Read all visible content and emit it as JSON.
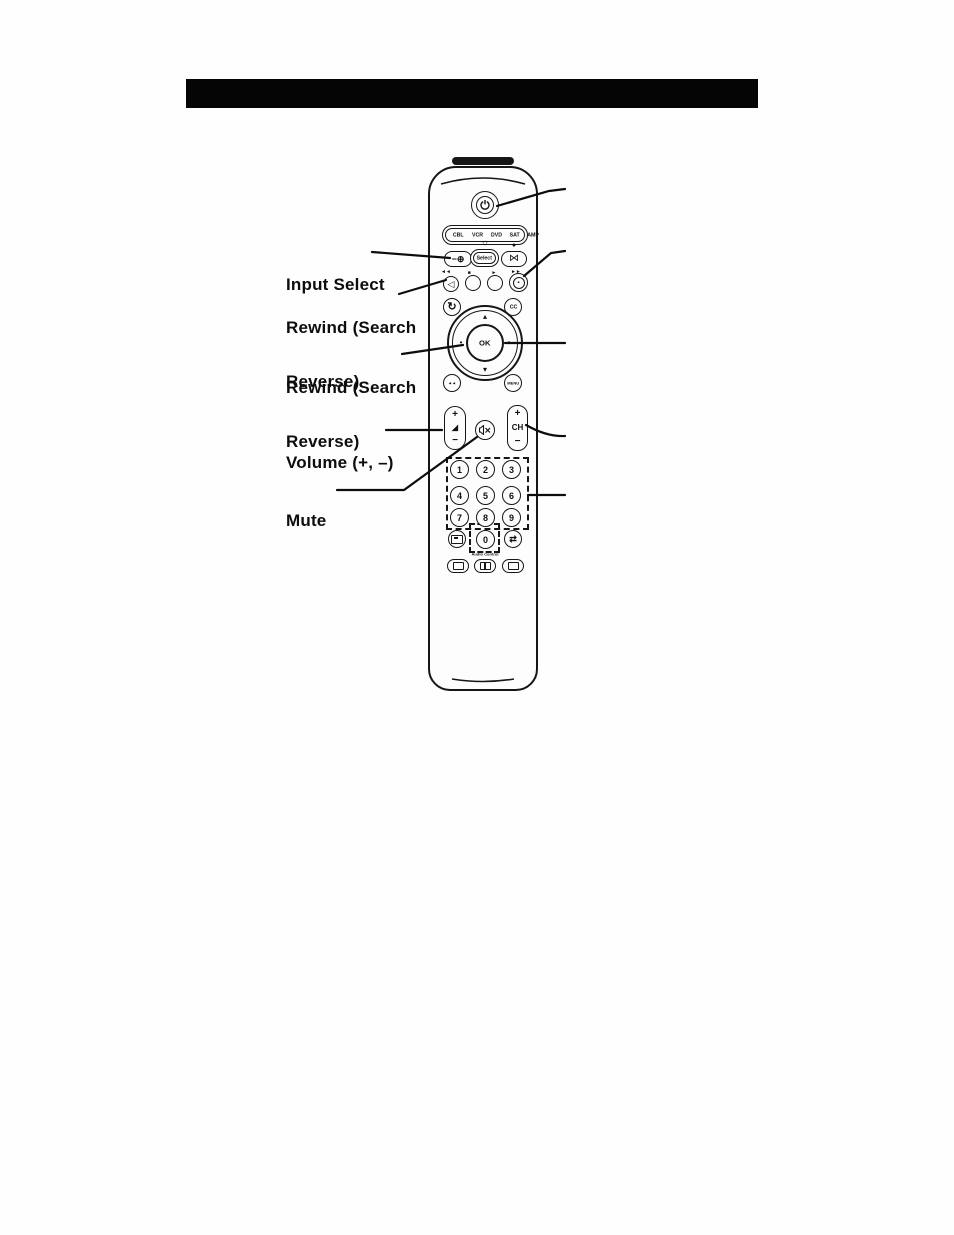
{
  "page": {
    "bg": "#ffffff",
    "ink": "#111111"
  },
  "callout_labels": [
    {
      "line1": "Input Select",
      "line2": ""
    },
    {
      "line1": "Rewind (Search",
      "line2": "Reverse)"
    },
    {
      "line1": "Rewind (Search",
      "line2": "Reverse)"
    },
    {
      "line1": "Volume (+, –)",
      "line2": ""
    },
    {
      "line1": "Mute",
      "line2": ""
    }
  ],
  "remote": {
    "device_labels": [
      "CBL",
      "VCR",
      "DVD",
      "SAT",
      "AMP"
    ],
    "select_label": "Select",
    "cc_label": "CC",
    "ok_label": "OK",
    "menu_label": "MENU",
    "ch_label": "CH",
    "plus": "+",
    "minus": "−",
    "digits": [
      "1",
      "2",
      "3",
      "4",
      "5",
      "6",
      "7",
      "8",
      "9"
    ],
    "zero": "0",
    "audio_control_label": "Audio Control",
    "icons": {
      "input": "−⊕",
      "select_star": "☼",
      "record_dot": "●",
      "format": "⋈",
      "mark_rew": "◄◄",
      "mark_stop": "■",
      "mark_play": "►",
      "mark_ff": "►►",
      "rewind": "◁",
      "ff_inner": "▪",
      "replay": "↻",
      "skip": "◄◄",
      "vol_ramp": "◢",
      "ok_up": "▴",
      "ok_down": "▾",
      "ok_left_dot": "•",
      "ok_right_dot": "•",
      "pip": "⇄"
    }
  }
}
